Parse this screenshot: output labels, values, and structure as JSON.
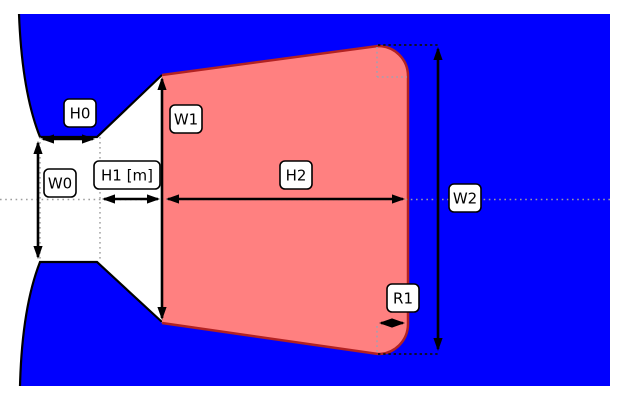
{
  "figure": {
    "canvas": {
      "width": 623,
      "height": 400
    },
    "colors": {
      "background": "#ffffff",
      "fluid_region": "#0000ff",
      "channel_fill": "#ffffff",
      "wall_edge": "#000000",
      "plume_fill": "#ff8080",
      "plume_edge": "#b22222",
      "centerline": "#9e9e9e",
      "guide_gray": "#8a8a8a",
      "guide_black": "#111111",
      "guide_corner": "#93a6b8",
      "arrow": "#000000",
      "label_bg": "#ffffff",
      "label_border": "#000000",
      "label_text": "#000000"
    },
    "dimensions": [
      {
        "id": "h0",
        "label": "H0",
        "label_center": [
          80,
          113
        ],
        "arrow": [
          41,
          139,
          95,
          139
        ]
      },
      {
        "id": "w0",
        "label": "W0",
        "label_center": [
          60,
          183
        ],
        "arrow": [
          38,
          141,
          38,
          259
        ]
      },
      {
        "id": "h1",
        "label": "H1 [m]",
        "label_center": [
          127,
          175
        ],
        "arrow": [
          102,
          199,
          160,
          199
        ]
      },
      {
        "id": "w1",
        "label": "W1",
        "label_center": [
          186,
          119
        ],
        "arrow": [
          162,
          77,
          162,
          320
        ]
      },
      {
        "id": "h2",
        "label": "H2",
        "label_center": [
          296,
          175
        ],
        "arrow": [
          166,
          199,
          405,
          199
        ]
      },
      {
        "id": "w2",
        "label": "W2",
        "label_center": [
          465,
          198
        ],
        "arrow": [
          438,
          47,
          438,
          351
        ]
      },
      {
        "id": "r1",
        "label": "R1",
        "label_center": [
          403,
          298
        ],
        "arrow": [
          379,
          323,
          405,
          323
        ]
      }
    ]
  }
}
